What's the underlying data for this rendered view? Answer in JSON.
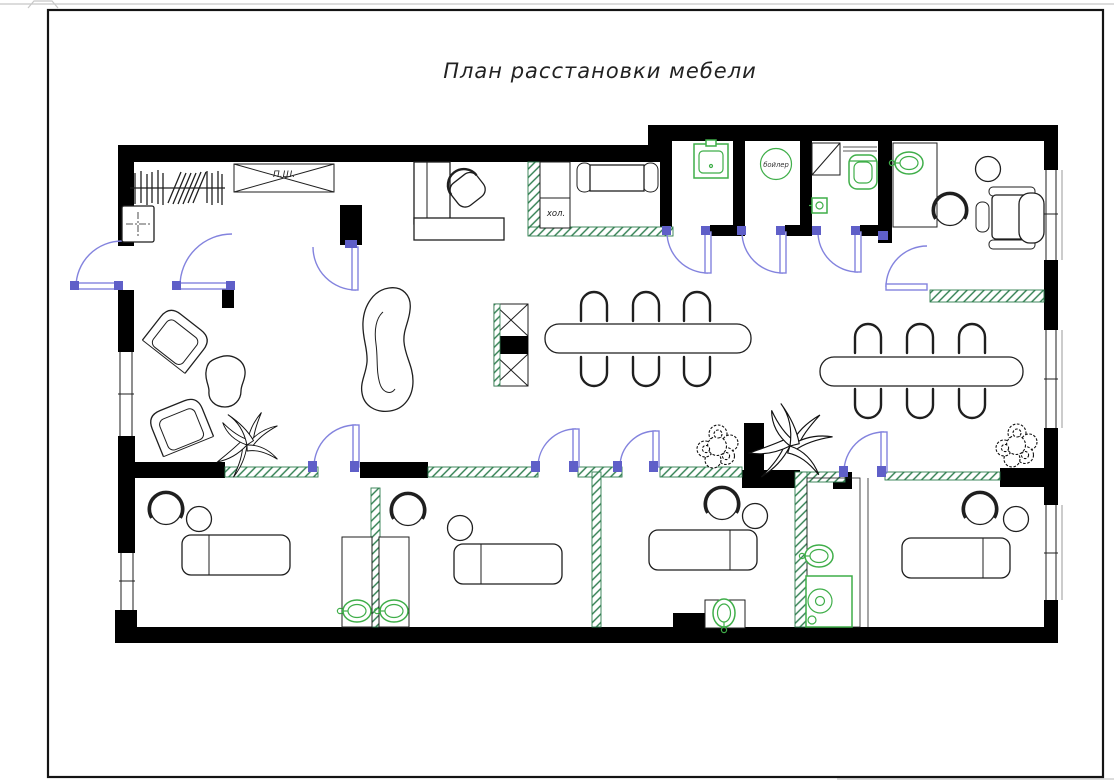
{
  "page": {
    "title": "План расстановки мебели"
  },
  "labels": {
    "wall_cabinet": "П.Ш.",
    "fridge": "хол.",
    "boiler": "бойлер"
  },
  "colors": {
    "wall": "#000000",
    "line": "#1f1f1f",
    "door_blue": "#8383de",
    "door_hinge_blue": "#5f5fc8",
    "fixture_green": "#3fae49",
    "hatch_green": "#2e7d4e",
    "frame": "#141414"
  }
}
